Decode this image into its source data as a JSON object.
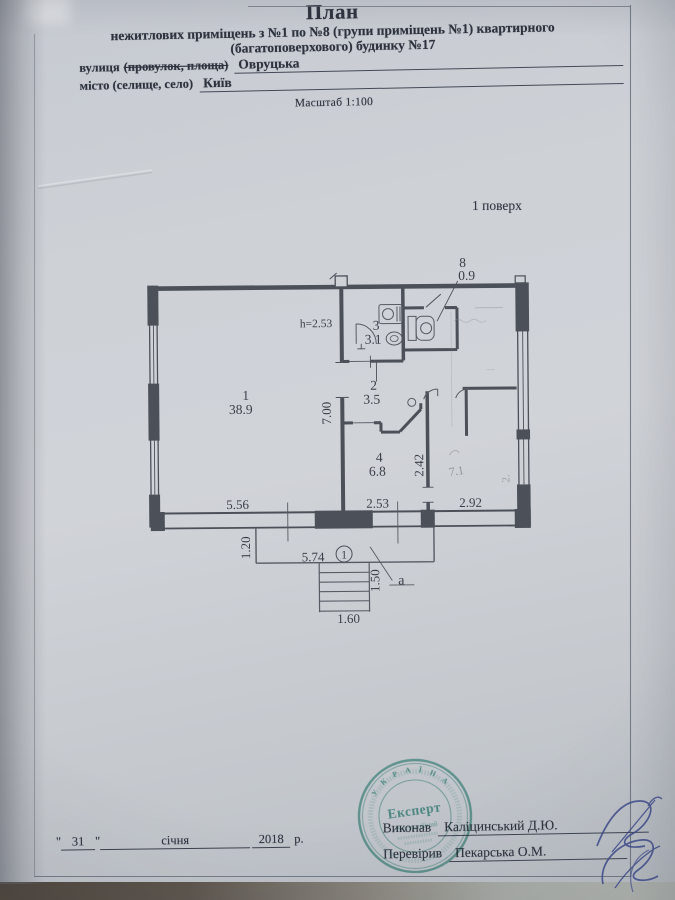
{
  "document": {
    "title": "План",
    "subtitle_line1": "нежитлових приміщень з №1 по №8 (групи приміщень №1) квартирного",
    "subtitle_line2": "(багатоповерхового) будинку №17",
    "street_label": "вулиця",
    "street_label_struck": "(провулок, площа)",
    "street_value": "Овруцька",
    "city_label": "місто (селище, село)",
    "city_value": "Київ",
    "scale_label": "Масштаб 1:100",
    "floor_label": "1 поверх"
  },
  "plan": {
    "ceiling_height": "h=2.53",
    "rooms": [
      {
        "number": "1",
        "area": "38.9"
      },
      {
        "number": "2",
        "area": "3.5"
      },
      {
        "number": "3",
        "area": "3.1"
      },
      {
        "number": "4",
        "area": "6.8"
      },
      {
        "number": "8",
        "area": "0.9"
      }
    ],
    "faint_room_area": "7.1",
    "faint_dim": "2.",
    "dims": {
      "room1_width": "5.56",
      "room1_depth": "7.00",
      "room4_width": "2.53",
      "room4_depth": "2.42",
      "right_room_width": "2.92",
      "porch_depth": "1.20",
      "porch_width": "5.74",
      "stairs_depth": "1.50",
      "stairs_width": "1.60"
    },
    "entry_mark": "1",
    "stairs_letter": "a"
  },
  "footer": {
    "date": {
      "q1": "\"",
      "day": "31",
      "q2": "\"",
      "month": "січня",
      "year": "2018",
      "suffix": "р."
    },
    "executed_label": "Виконав",
    "executed_name": "Каліцинський Д.Ю.",
    "checked_label": "Перевірив",
    "checked_name": "Пекарська О.М.",
    "stamp": {
      "arc_top": "У К Р А Ї Н А",
      "center": "Експерт",
      "line2": "Реєстраційний"
    }
  },
  "colors": {
    "paper": "#ced2d7",
    "ink": "#2d323e",
    "plan_line": "#4b5059",
    "stamp": "#3f9a8b",
    "signature": "#3d4a8d"
  }
}
